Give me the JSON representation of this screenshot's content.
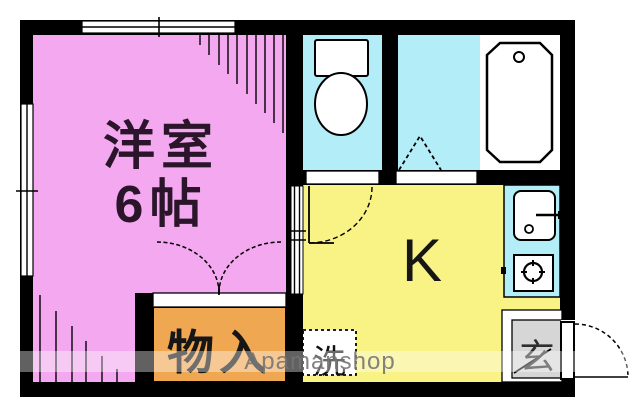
{
  "floorplan": {
    "watermark": "Apamanshop",
    "labels": {
      "western_room_line1": "洋室",
      "western_room_line2": "6帖",
      "kitchen": "K",
      "storage": "物入",
      "entrance": "玄",
      "laundry": "洗"
    },
    "colors": {
      "western_room": "#f3a8ef",
      "kitchen": "#f9f285",
      "water_area": "#b3edf8",
      "bath_zone": "#ffffff",
      "storage": "#f0a751",
      "entrance_floor": "#d6d6d6",
      "wall": "#000000"
    },
    "icons": [
      "toilet-icon",
      "bathtub-icon",
      "sink-icon",
      "stove-burner-icon",
      "washing-machine-icon",
      "entrance-door-icon",
      "folding-door-icon",
      "double-door-icon",
      "sliding-window-icon",
      "hinged-door-icon"
    ]
  }
}
